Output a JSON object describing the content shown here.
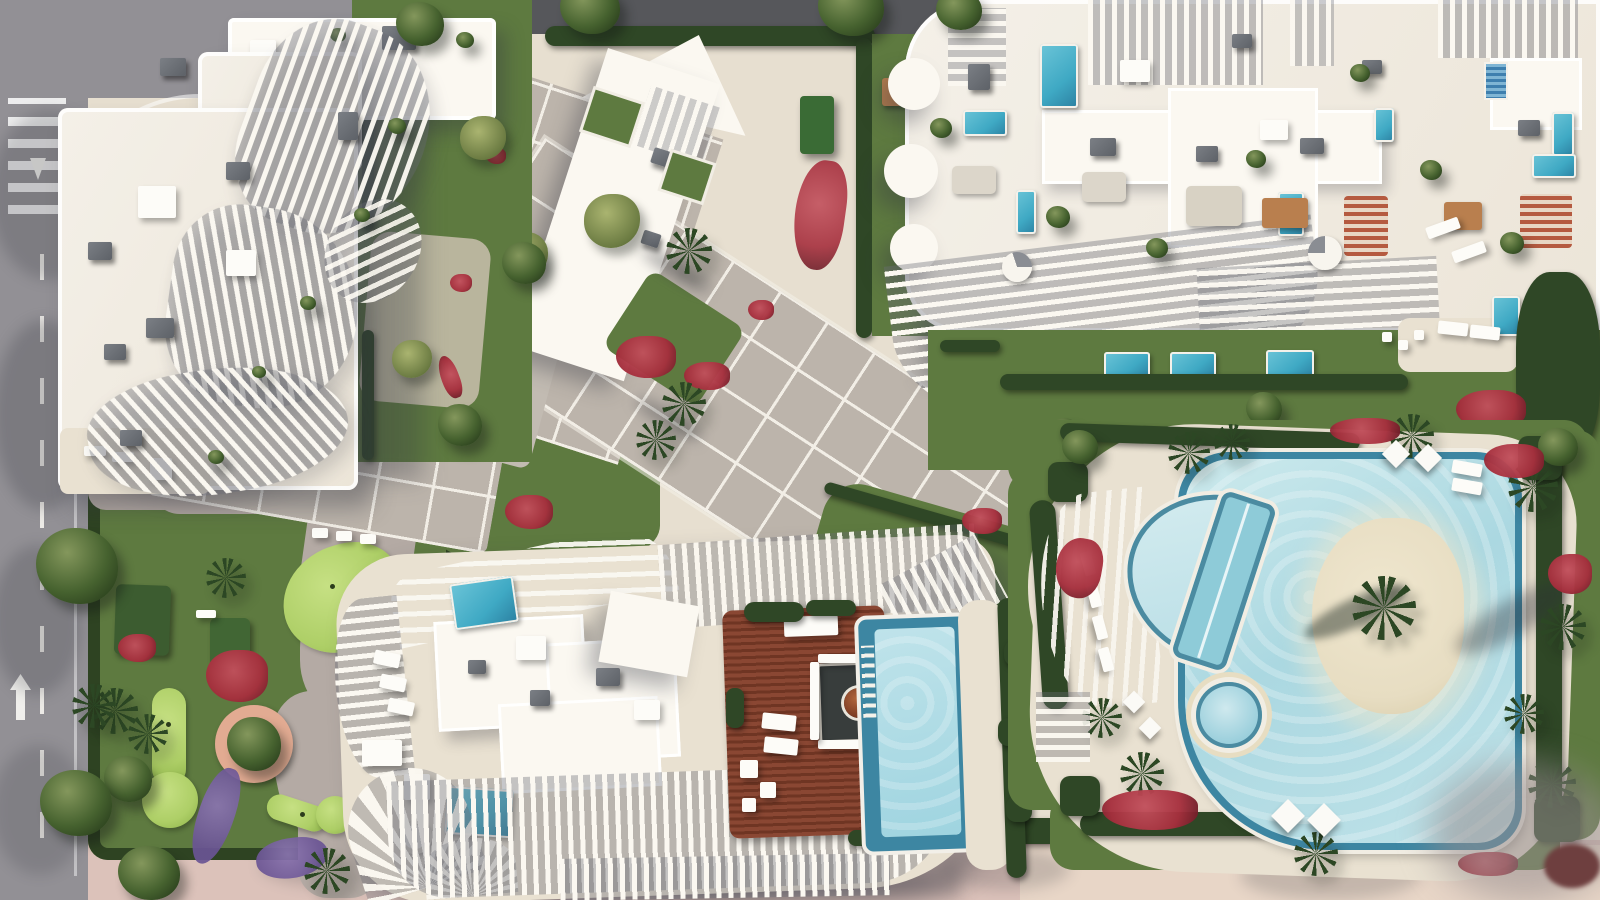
{
  "meta": {
    "description": "Top-down aerial 3D architectural rendering of a residential resort complex with three white apartment buildings, a striped central plaza, gardens, a putting-green park, a rooftop timber deck with lap pool and a large free-form lagoon pool with sand island.",
    "image_width": 1600,
    "image_height": 900,
    "visible_text": ""
  },
  "palette": {
    "road": "#929095",
    "road_dark": "#56575b",
    "road_marking": "#eceae6",
    "pavement_pink": "#dcc2ba",
    "pavement_cream": "#e9d8c9",
    "roof_white": "#f4f0e8",
    "roof_bright": "#fbf8f1",
    "roof_box": "#5d6167",
    "plaza": "#bcb4ab",
    "plaza_line": "#f2eee6",
    "path": "#b4aaa4",
    "lawn": "#5e7a40",
    "lawn_light": "#728c4e",
    "putting_green": "#aecf67",
    "hedge": "#2f4726",
    "tree": "#46622f",
    "palm": "#2c4724",
    "flower_red": "#a62f3d",
    "flower_purple": "#6a5494",
    "pool_water": "#b7dde4",
    "pool_rim": "#3d86a2",
    "plunge_pool": "#3fa9c4",
    "sand": "#e7ddc2",
    "deck_cream": "#e9e1d1",
    "wood_deck": "#7e4030",
    "wood_table": "#b97f4e"
  },
  "scene": {
    "road_west": {
      "label": "Asphalt road with dashed lane markings"
    },
    "crosswalk": {
      "label": "Pedestrian crosswalk"
    },
    "road_north": {
      "label": "North access road"
    },
    "building_nw": {
      "label": "North-west building with curved ribbed balconies"
    },
    "building_ne": {
      "label": "North-east building with rooftop terraces and plunge pools"
    },
    "building_s": {
      "label": "South building with rooftop timber deck and lap pool"
    },
    "plaza": {
      "label": "Central paved plaza with white paving grid"
    },
    "roof_walkway": {
      "label": "White elevated walkway roof"
    },
    "pool_area": {
      "label": "Resort lagoon pool area"
    },
    "main_pool": {
      "label": "Free-form lagoon pool"
    },
    "island": {
      "label": "Sand island with palm tree"
    },
    "spa_pool": {
      "label": "Round spa pool"
    },
    "shallow_pool": {
      "label": "Semicircular beach-entry pool"
    },
    "lap_pool": {
      "label": "Straight swimming lane"
    },
    "wood_deck": {
      "label": "Rooftop timber deck lounge"
    },
    "deck_pool": {
      "label": "Rooftop infinity lap pool"
    },
    "minigolf": {
      "label": "Putting-green garden"
    },
    "promenade": {
      "label": "South promenade pavement"
    },
    "fitness_lawn": {
      "label": "Fitness lawn"
    },
    "ne_garden": {
      "label": "Private gardens with plunge pools"
    }
  }
}
